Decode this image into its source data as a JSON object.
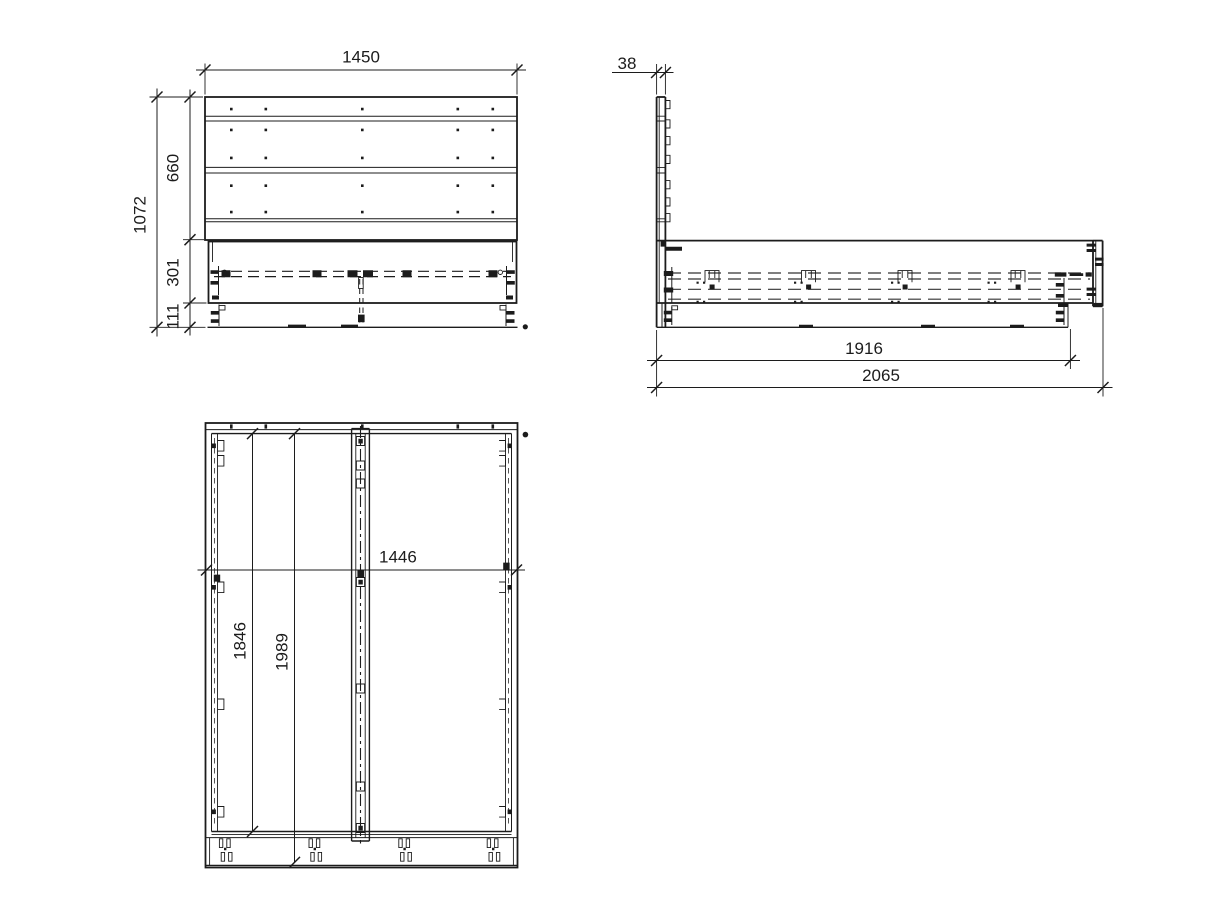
{
  "drawing": {
    "background_color": "#ffffff",
    "line_color": "#1c1c1c",
    "hidden_line_color": "#333333"
  },
  "dimensions": {
    "front": {
      "overall_width": "1450",
      "overall_height": "1072",
      "headboard_height": "660",
      "rail_height": "301",
      "leg_height": "111"
    },
    "side": {
      "headboard_thickness": "38",
      "rail_length": "1916",
      "overall_length": "2065"
    },
    "plan": {
      "inner_width": "1446",
      "inner_length": "1846",
      "overall_length": "1989"
    }
  }
}
